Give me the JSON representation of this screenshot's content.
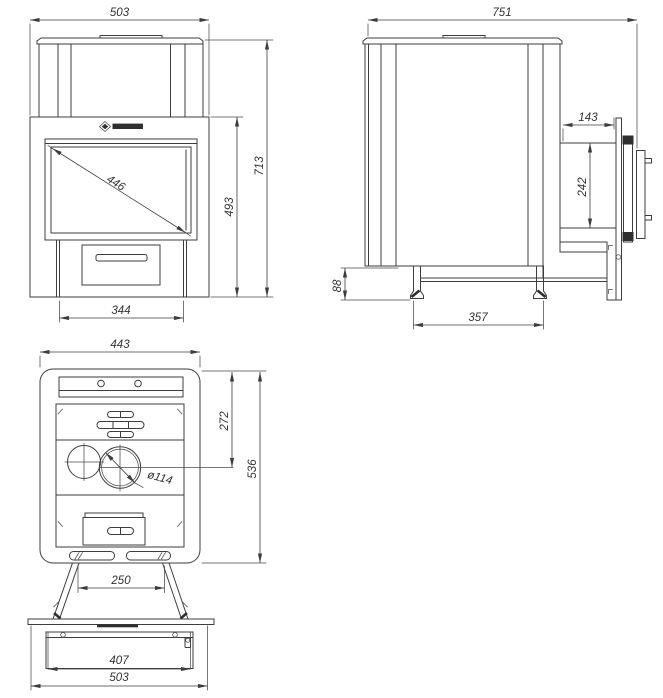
{
  "page": {
    "background": "#ffffff",
    "line_color": "#3d3d3d",
    "drawing_type": "stove technical drawing, three dimensioned views"
  },
  "views": {
    "front": {
      "title": "front view",
      "dims": {
        "top_width": "503",
        "total_height": "713",
        "body_height": "493",
        "glass_diagonal": "446",
        "plinth_width": "344"
      }
    },
    "side": {
      "title": "side view",
      "dims": {
        "total_depth": "751",
        "door_depth": "143",
        "door_height": "242",
        "leg_height": "88",
        "leg_spacing": "357"
      }
    },
    "rear": {
      "title": "rear view with base plate",
      "dims": {
        "body_width": "443",
        "flue_center_offset": "272",
        "body_height": "536",
        "flue_diameter": "ø114",
        "leg_spacing": "250",
        "base_plate_inner_width": "407",
        "base_plate_width": "503"
      }
    }
  }
}
